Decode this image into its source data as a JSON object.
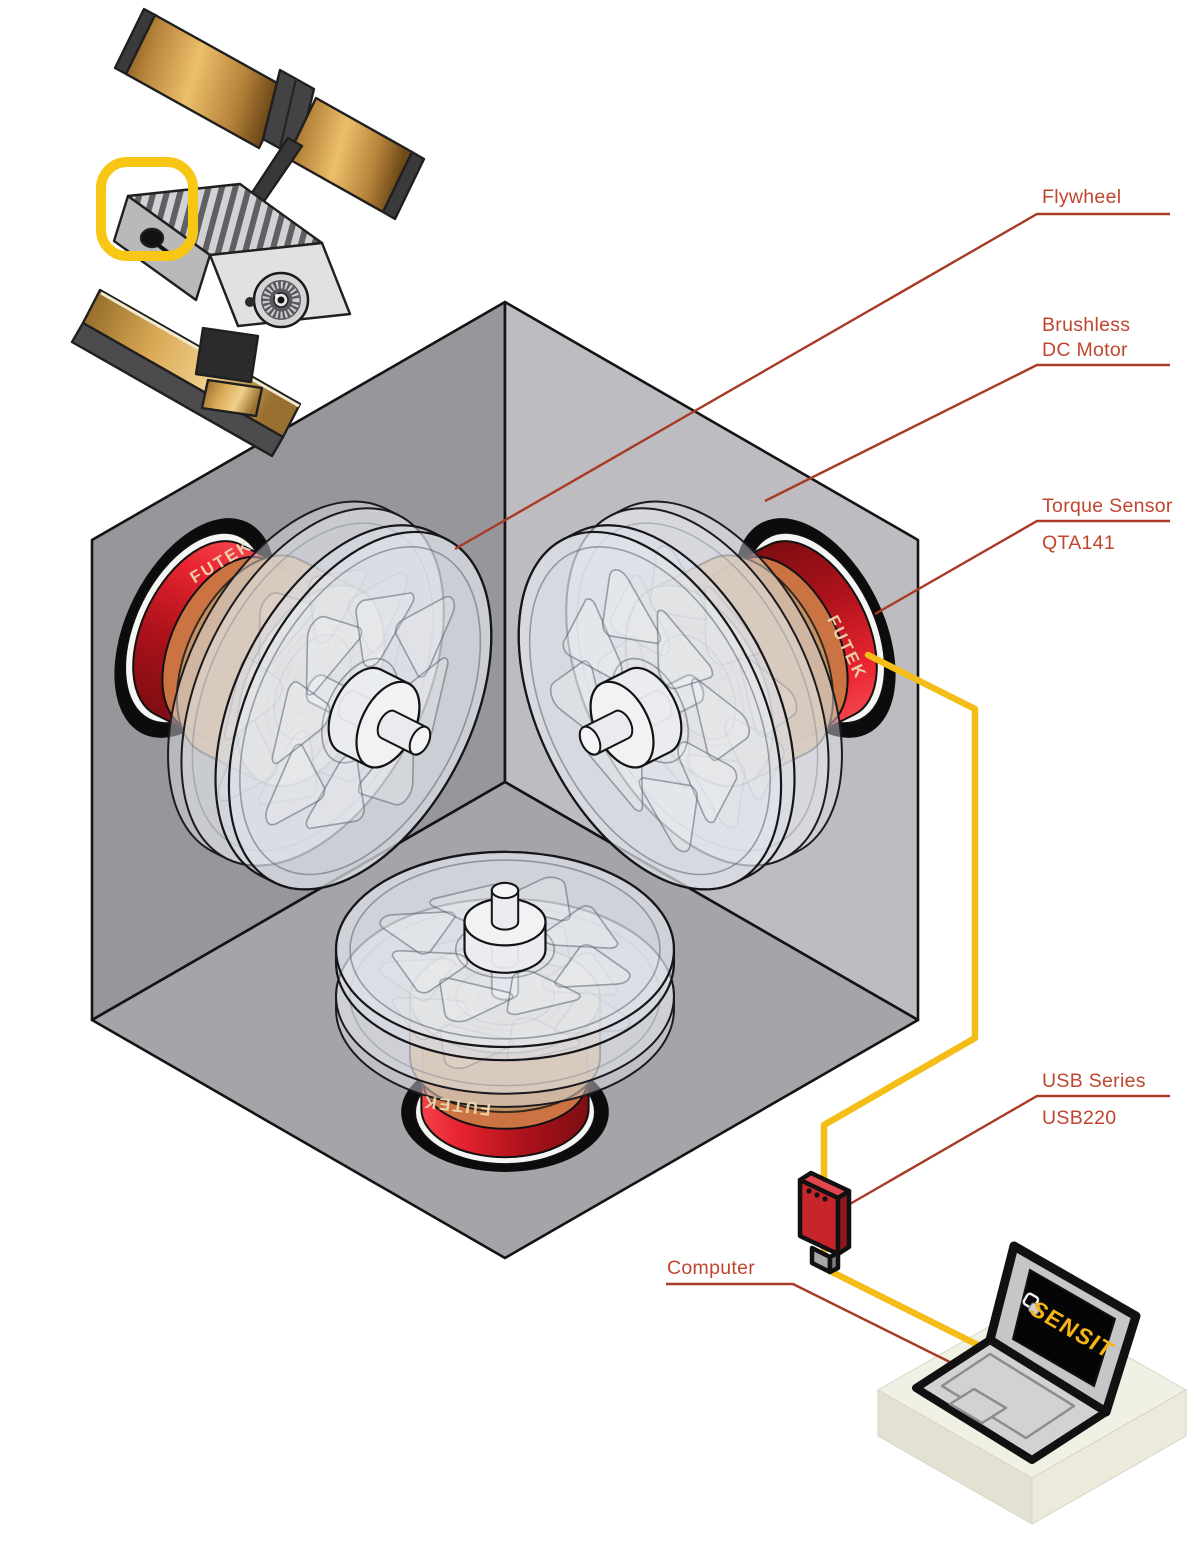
{
  "callouts": {
    "flywheel": "Flywheel",
    "motor_line1": "Brushless",
    "motor_line2": "DC Motor",
    "torque_sensor": "Torque Sensor",
    "torque_sensor_model": "QTA141",
    "usb_series": "USB Series",
    "usb_series_model": "USB220",
    "computer": "Computer"
  },
  "branding": {
    "sensor_brand": "FUTEK",
    "laptop_logo": "SENSIT"
  },
  "colors": {
    "callout_text": "#c0452e",
    "callout_line": "#a93b26",
    "cable_yellow": "#f5bd18",
    "highlight_yellow": "#f8c715",
    "sensor_red": "#d6121f",
    "sensor_band_orange": "#cb7342",
    "motor_tan": "#c49769",
    "usb_device_red": "#c8242b",
    "solar_panel_gold": "#d9a84e",
    "cube_left_wall": "#96969b",
    "cube_right_wall": "#bdbdc1",
    "cube_floor": "#a4a4a9"
  }
}
